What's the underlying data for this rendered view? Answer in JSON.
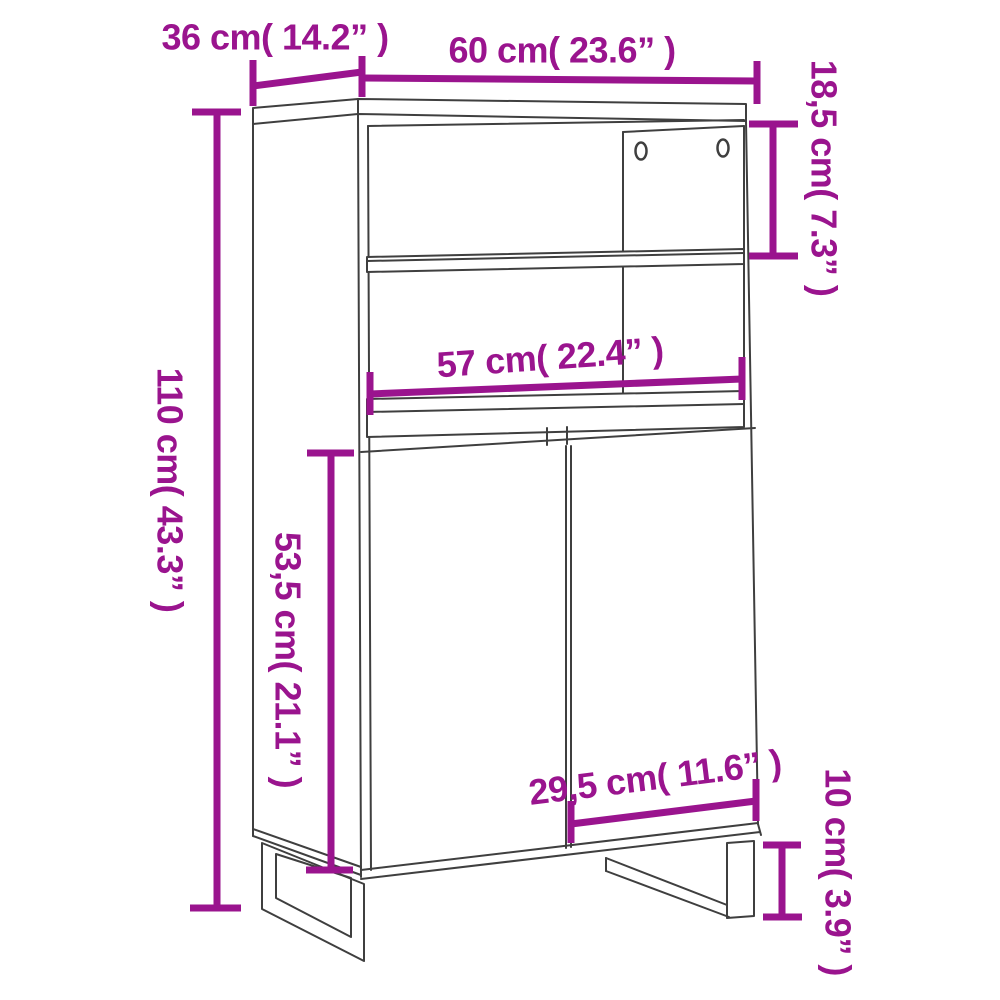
{
  "page": {
    "background": "#ffffff"
  },
  "diagram": {
    "title": "Highboard cabinet dimension line drawing",
    "accent_color": "#9A148E",
    "line_color": "#3F3F3F",
    "dimensions": [
      {
        "name": "top-depth",
        "label": "36 cm( 14.2” )",
        "orientation": "horizontal"
      },
      {
        "name": "top-width",
        "label": "60 cm( 23.6” )",
        "orientation": "horizontal"
      },
      {
        "name": "upper-compartment-height",
        "label": "18,5 cm( 7.3” )",
        "orientation": "vertical"
      },
      {
        "name": "total-height",
        "label": "110 cm( 43.3” )",
        "orientation": "vertical"
      },
      {
        "name": "inner-shelf-width",
        "label": "57 cm( 22.4” )",
        "orientation": "horizontal"
      },
      {
        "name": "door-section-height",
        "label": "53,5 cm( 21.1” )",
        "orientation": "vertical"
      },
      {
        "name": "door-width",
        "label": "29,5 cm( 11.6” )",
        "orientation": "horizontal"
      },
      {
        "name": "leg-height",
        "label": "10 cm( 3.9” )",
        "orientation": "vertical"
      }
    ]
  }
}
